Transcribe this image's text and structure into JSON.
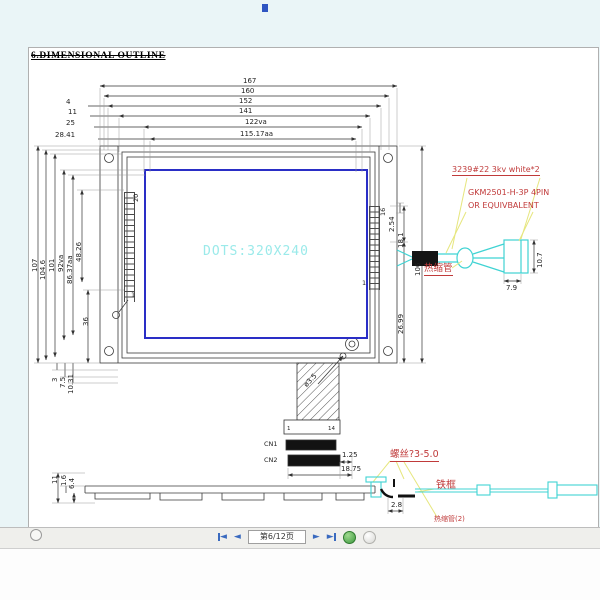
{
  "title": "6.DIMENSIONAL OUTLINE",
  "front_view": {
    "display_text": "DOTS:320X240",
    "hole_dim": "ø3.5"
  },
  "dims_top": {
    "d167": "167",
    "d160": "160",
    "d152": "152",
    "d141": "141",
    "d122": "122va",
    "d115": "115.17aa",
    "o4": "4",
    "o11": "11",
    "o25": "25",
    "o28": "28.41"
  },
  "dims_left": {
    "v107": "107",
    "v104": "104.6",
    "v101": "101",
    "v92": "92va",
    "v86": "86.37aa",
    "v48": "48.26",
    "v36": "36",
    "b3": "3",
    "b7": "7.5",
    "b10": "10.31"
  },
  "dims_right": {
    "p254": "2.54",
    "p18": "18.1",
    "p26": "26.99",
    "h106": "106",
    "pin20": "20",
    "pin16": "16",
    "pin1_left": "1",
    "pin1_right": "1"
  },
  "connector": {
    "cn1": "CN1",
    "cn2": "CN2",
    "pin_first": "1",
    "pin_last": "14",
    "d125": "1.25",
    "d1875": "18.75"
  },
  "cable": {
    "w79": "7.9",
    "w107": "10.7"
  },
  "side_view": {
    "s11": "11",
    "s16": "1.6",
    "s64": "6.4",
    "s28": "2.8"
  },
  "annotations": {
    "wire_spec": "3239#22 3kv white*2",
    "connector_model": "GKM2501-H-3P 4PIN",
    "connector_model2": "OR EQUIVBALENT",
    "heat_shrink": "热缩管",
    "screw": "螺丝?3-5.0",
    "iron_frame": "铁框",
    "heat_shrink2": "热缩管(2)"
  },
  "toolbar": {
    "page_indicator": "第6/12页"
  },
  "colors": {
    "annotation_red": "#c03a3a",
    "drawing_cyan": "#3fd3d3",
    "display_text_cyan": "#9beaea",
    "display_border_blue": "#2a2ec6",
    "leader_yellow": "#e6e67e",
    "toolbar_icon_blue": "#3a6abf"
  }
}
